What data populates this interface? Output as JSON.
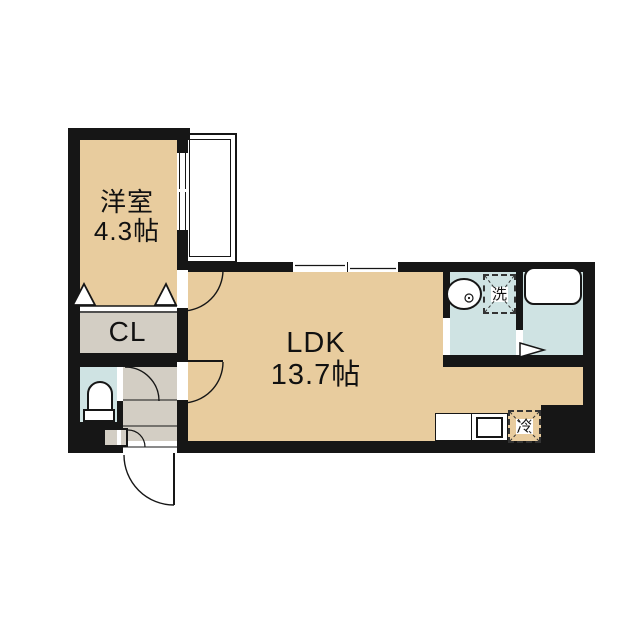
{
  "plan": {
    "rooms": {
      "western": {
        "name": "洋室",
        "size": "4.3帖"
      },
      "closet": {
        "name": "CL"
      },
      "ldk": {
        "name": "LDK",
        "size": "13.7帖"
      }
    },
    "fixtures": {
      "washer_symbol": "洗",
      "fridge_symbol": "冷"
    },
    "colors": {
      "room_tan": "#e8cc9e",
      "service_gray": "#d3cec4",
      "wet_blue": "#cfe3e3",
      "wall_black": "#161616"
    }
  }
}
